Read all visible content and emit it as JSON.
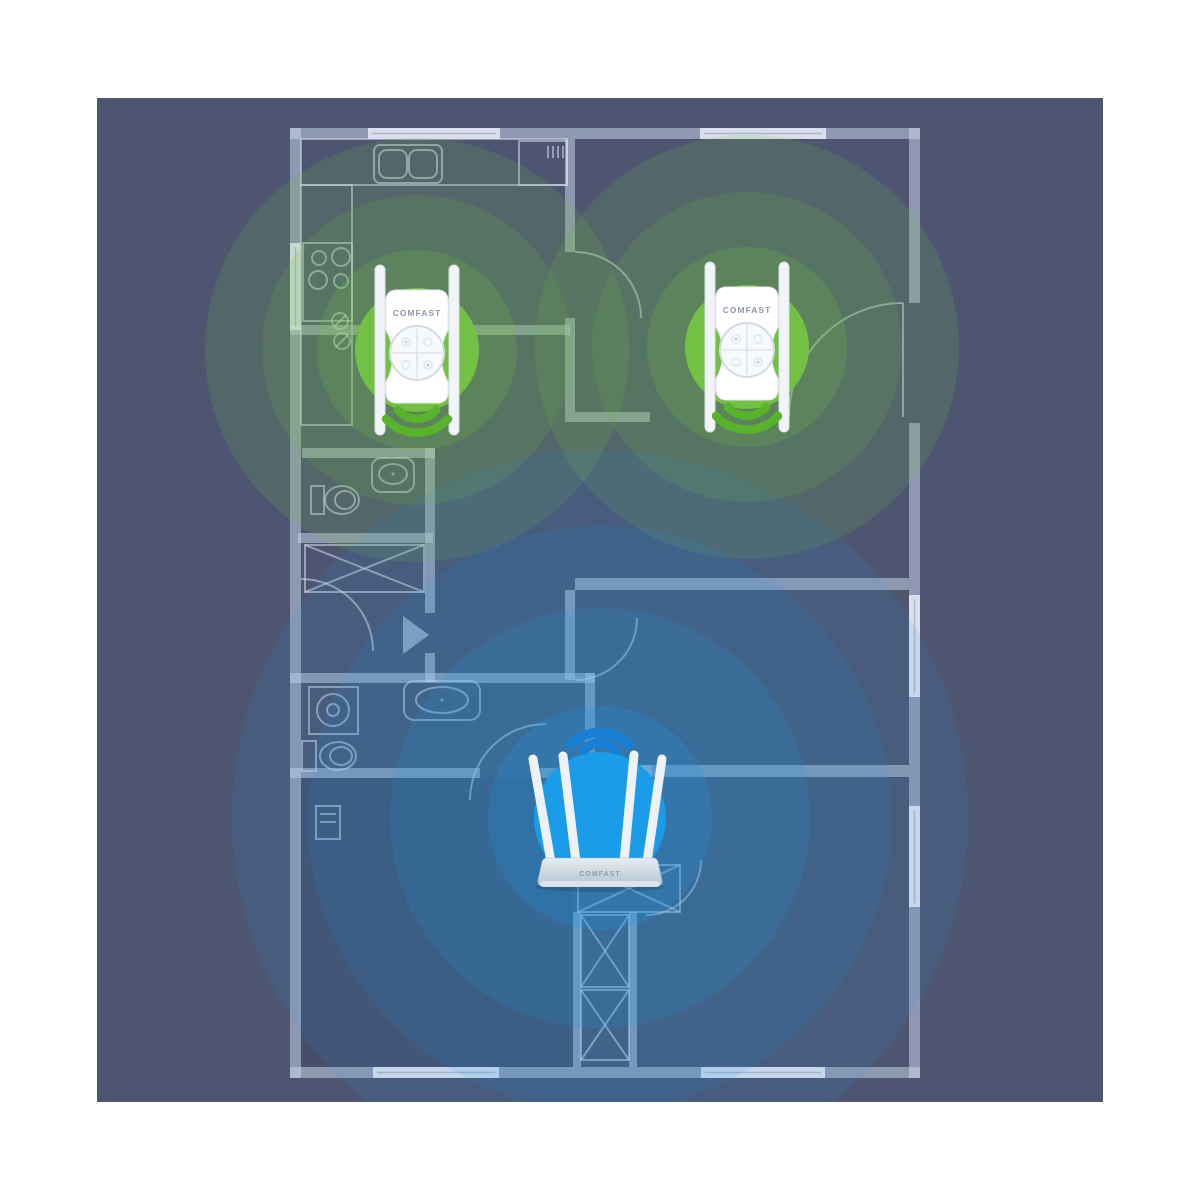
{
  "scene": {
    "background_color": "#4d5571",
    "frame_color": "#ffffff",
    "wall_color": "#ccd6ea",
    "line_color": "#d6deee"
  },
  "devices": {
    "repeater_brand": "COMFAST",
    "router_brand": "COMFAST",
    "repeaters": [
      {
        "x": 417,
        "y": 350
      },
      {
        "x": 747,
        "y": 347
      }
    ],
    "router": {
      "x": 600,
      "y": 872
    }
  },
  "coverage": {
    "repeater_color": "#72c044",
    "repeater_signal_icon_color": "#58b32a",
    "repeater_rings": [
      {
        "r": 212,
        "opacity": 0.17
      },
      {
        "r": 155,
        "opacity": 0.15
      },
      {
        "r": 100,
        "opacity": 0.22
      },
      {
        "r": 62,
        "opacity": 1
      }
    ],
    "router_color": "#1b9ce8",
    "router_signal_icon_color": "#1780d6",
    "router_signal_center": {
      "x": 600,
      "y": 818
    },
    "router_rings": [
      {
        "r": 368,
        "opacity": 0.1
      },
      {
        "r": 292,
        "opacity": 0.12
      },
      {
        "r": 210,
        "opacity": 0.16
      },
      {
        "r": 112,
        "opacity": 0.22
      },
      {
        "r": 66,
        "opacity": 1
      }
    ]
  }
}
